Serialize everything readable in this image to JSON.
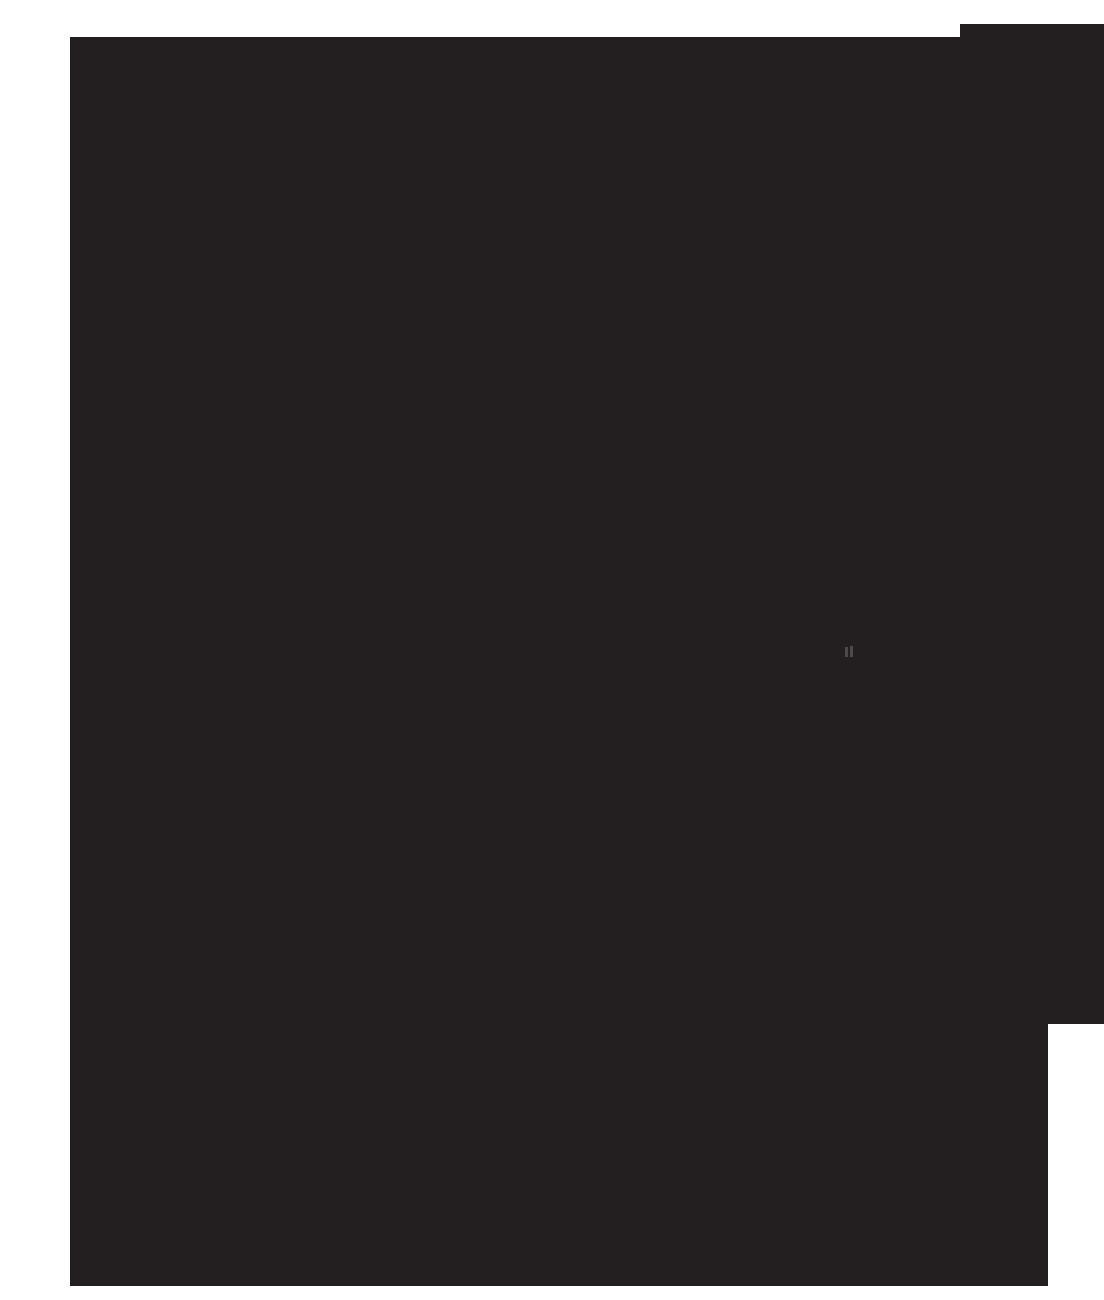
{
  "canvas": {
    "background_color": "#ffffff"
  },
  "black_region": {
    "color": "#231f20",
    "description": "large featureless dark area composed of two overlapping rectangles"
  },
  "mark": {
    "icon": "double-vertical-bars-icon",
    "color": "#4e4947",
    "description": "tiny faint gray double-bar glyph right of center of the dark area"
  }
}
